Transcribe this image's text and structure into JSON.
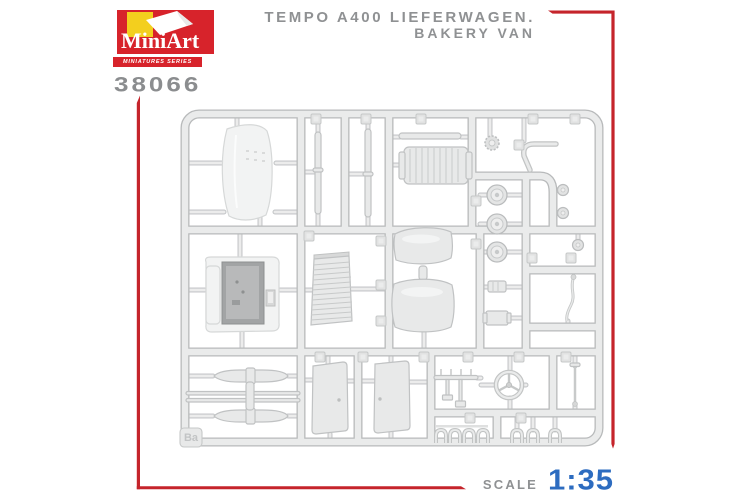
{
  "header": {
    "brand": "MiniArt",
    "series_label": "MINIATURES SERIES",
    "kit_number": "38066",
    "title_line1": "TEMPO A400 LIEFERWAGEN.",
    "title_line2": "BAKERY VAN"
  },
  "sprue": {
    "tag": "Ba",
    "description": "plastic parts sprue diagram"
  },
  "footer": {
    "scale_label": "SCALE",
    "scale_value": "1:35"
  },
  "colors": {
    "accent_red": "#c5242b",
    "logo_red": "#d7232b",
    "logo_yellow": "#f3cf1e",
    "text_gray": "#8f9193",
    "scale_blue": "#2d6cc0",
    "sprue_fill": "#eaebeb",
    "sprue_outline": "#b8babb"
  }
}
